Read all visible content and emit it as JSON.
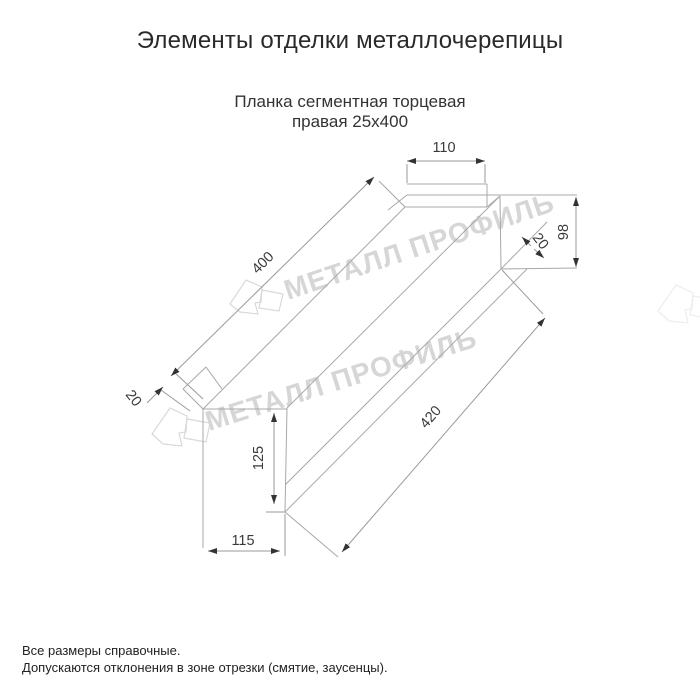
{
  "title": "Элементы отделки металлочерепицы",
  "subtitle_line1": "Планка сегментная торцевая",
  "subtitle_line2": "правая 25x400",
  "watermark": {
    "text": "МЕТАЛЛ ПРОФИЛЬ"
  },
  "dimensions": {
    "top_flange_width": "110",
    "end_height": "98",
    "top_length": "400",
    "top_hem": "20",
    "left_hem": "20",
    "bottom_length": "420",
    "face_height": "125",
    "bottom_width": "115"
  },
  "notes": [
    "Все размеры справочные.",
    "Допускаются отклонения в зоне отрезки (смятие, заусенцы)."
  ],
  "colors": {
    "line": "#a8a8a8",
    "dimension_text": "#3a3a3a",
    "arrow": "#333333",
    "watermark": "#d6d6d6"
  }
}
